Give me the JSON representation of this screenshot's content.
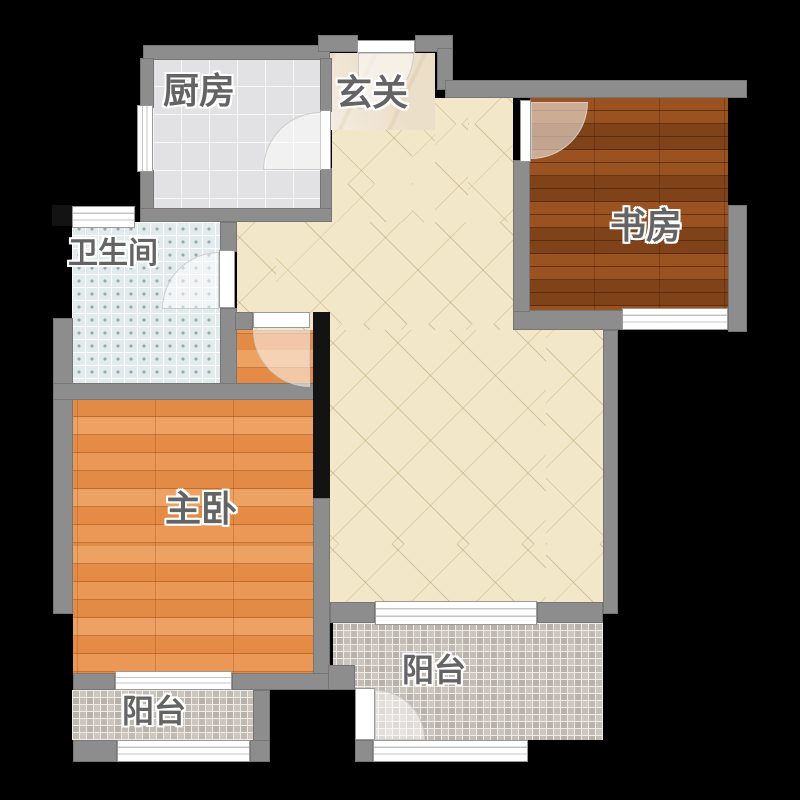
{
  "plan": {
    "rooms": {
      "kitchen": {
        "label": "厨房"
      },
      "entry": {
        "label": "玄关"
      },
      "study": {
        "label": "书房"
      },
      "bathroom": {
        "label": "卫生间"
      },
      "master_bedroom": {
        "label": "主卧"
      },
      "balcony_left": {
        "label": "阳台"
      },
      "balcony_right": {
        "label": "阳台"
      }
    }
  },
  "colors": {
    "bg": "#000000",
    "wall": "#8d8d8d",
    "wall_dark": "#131313",
    "floor_kitchen": "#e2e2e4",
    "floor_entry": "#ecdfca",
    "floor_living": "#f2e7c8",
    "floor_study": "#8e4a1c",
    "floor_bathroom": "#e2ebec",
    "floor_bedroom": "#e8914e",
    "floor_balcony": "#ccc6bf",
    "window_fill": "#ffffff",
    "label": "#646464"
  }
}
